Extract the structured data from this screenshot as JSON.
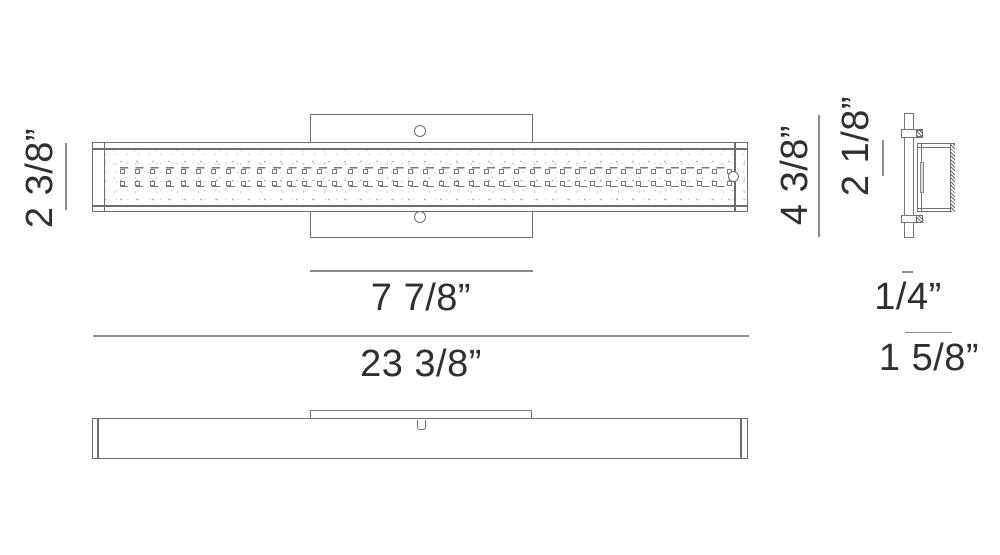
{
  "dimensions": {
    "front_height": "2 3/8”",
    "backplate_width": "7 7/8”",
    "overall_width": "23 3/8”",
    "backplate_height": "4 3/8”",
    "side_body_height": "2 1/8”",
    "backplate_depth": "1/4”",
    "overall_depth": "1 5/8”"
  },
  "front_view": {
    "led_columns": 41,
    "led_rows": 2,
    "screw_holes": 2
  },
  "colors": {
    "line": "#6e6e6e",
    "dim_line": "#8c8c8c",
    "text": "#2f2f2f",
    "background": "#ffffff"
  }
}
